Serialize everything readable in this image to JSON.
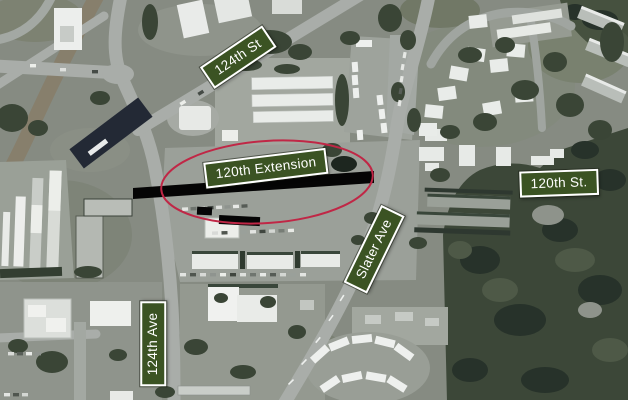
{
  "map": {
    "kind": "aerial-photo-annotated",
    "street_labels": [
      {
        "id": "st-124",
        "text": "124th St"
      },
      {
        "id": "extension-120",
        "text": "120th Extension"
      },
      {
        "id": "st-120",
        "text": "120th St."
      },
      {
        "id": "slater-ave",
        "text": "Slater Ave"
      },
      {
        "id": "ave-124",
        "text": "124th Ave"
      }
    ],
    "colors": {
      "label_background": "#3b5323",
      "label_border": "#ffffff",
      "label_text": "#ffffff",
      "study_outline": "#c02746",
      "extension_bar": "#050505"
    }
  }
}
